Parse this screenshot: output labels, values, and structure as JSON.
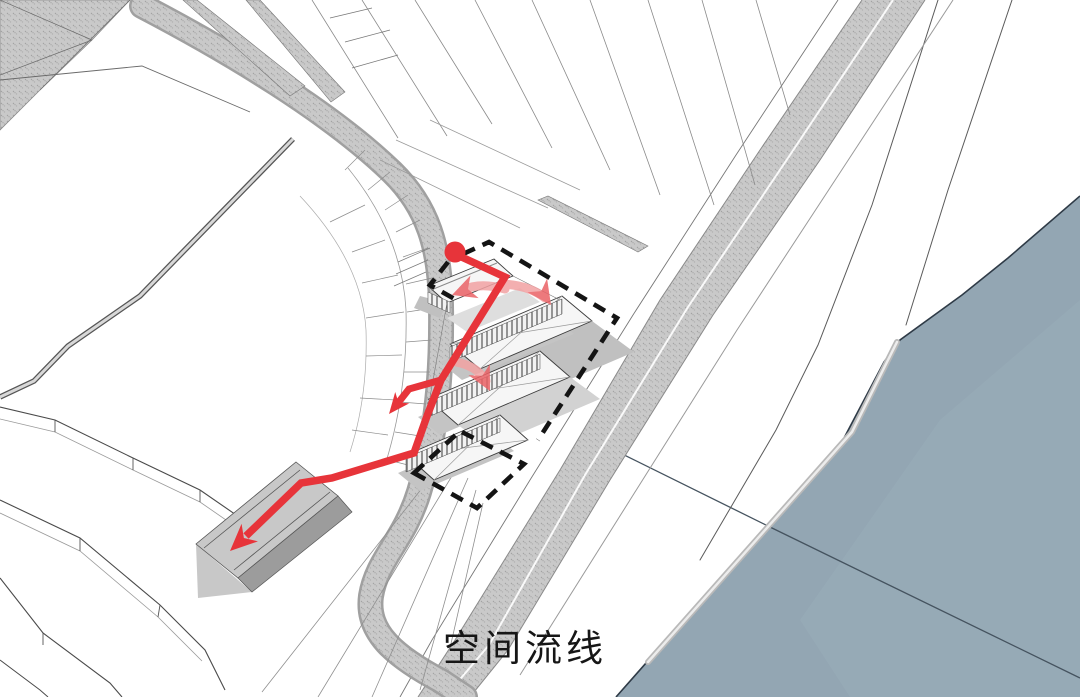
{
  "caption": {
    "text": "空间流线"
  },
  "colors": {
    "background": "#ffffff",
    "route_red": "#e7343a",
    "route_pink": "#f2a2a3",
    "route_pink_head": "#ea6266",
    "boundary_black": "#141414",
    "water": "#93a6b3",
    "water_edge": "#2f3b47",
    "water_line": "#45535f",
    "road_fill": "#c9c9c9",
    "road_edge": "#8a8a8a",
    "terrain_line_dark": "#4a4a4a",
    "terrain_line_mid": "#8f8f8f",
    "building_fill": "#f6f6f6",
    "building_line": "#3c3c3c",
    "shadow_gray": "#c2c2c2",
    "caption_ink": "#161616"
  }
}
